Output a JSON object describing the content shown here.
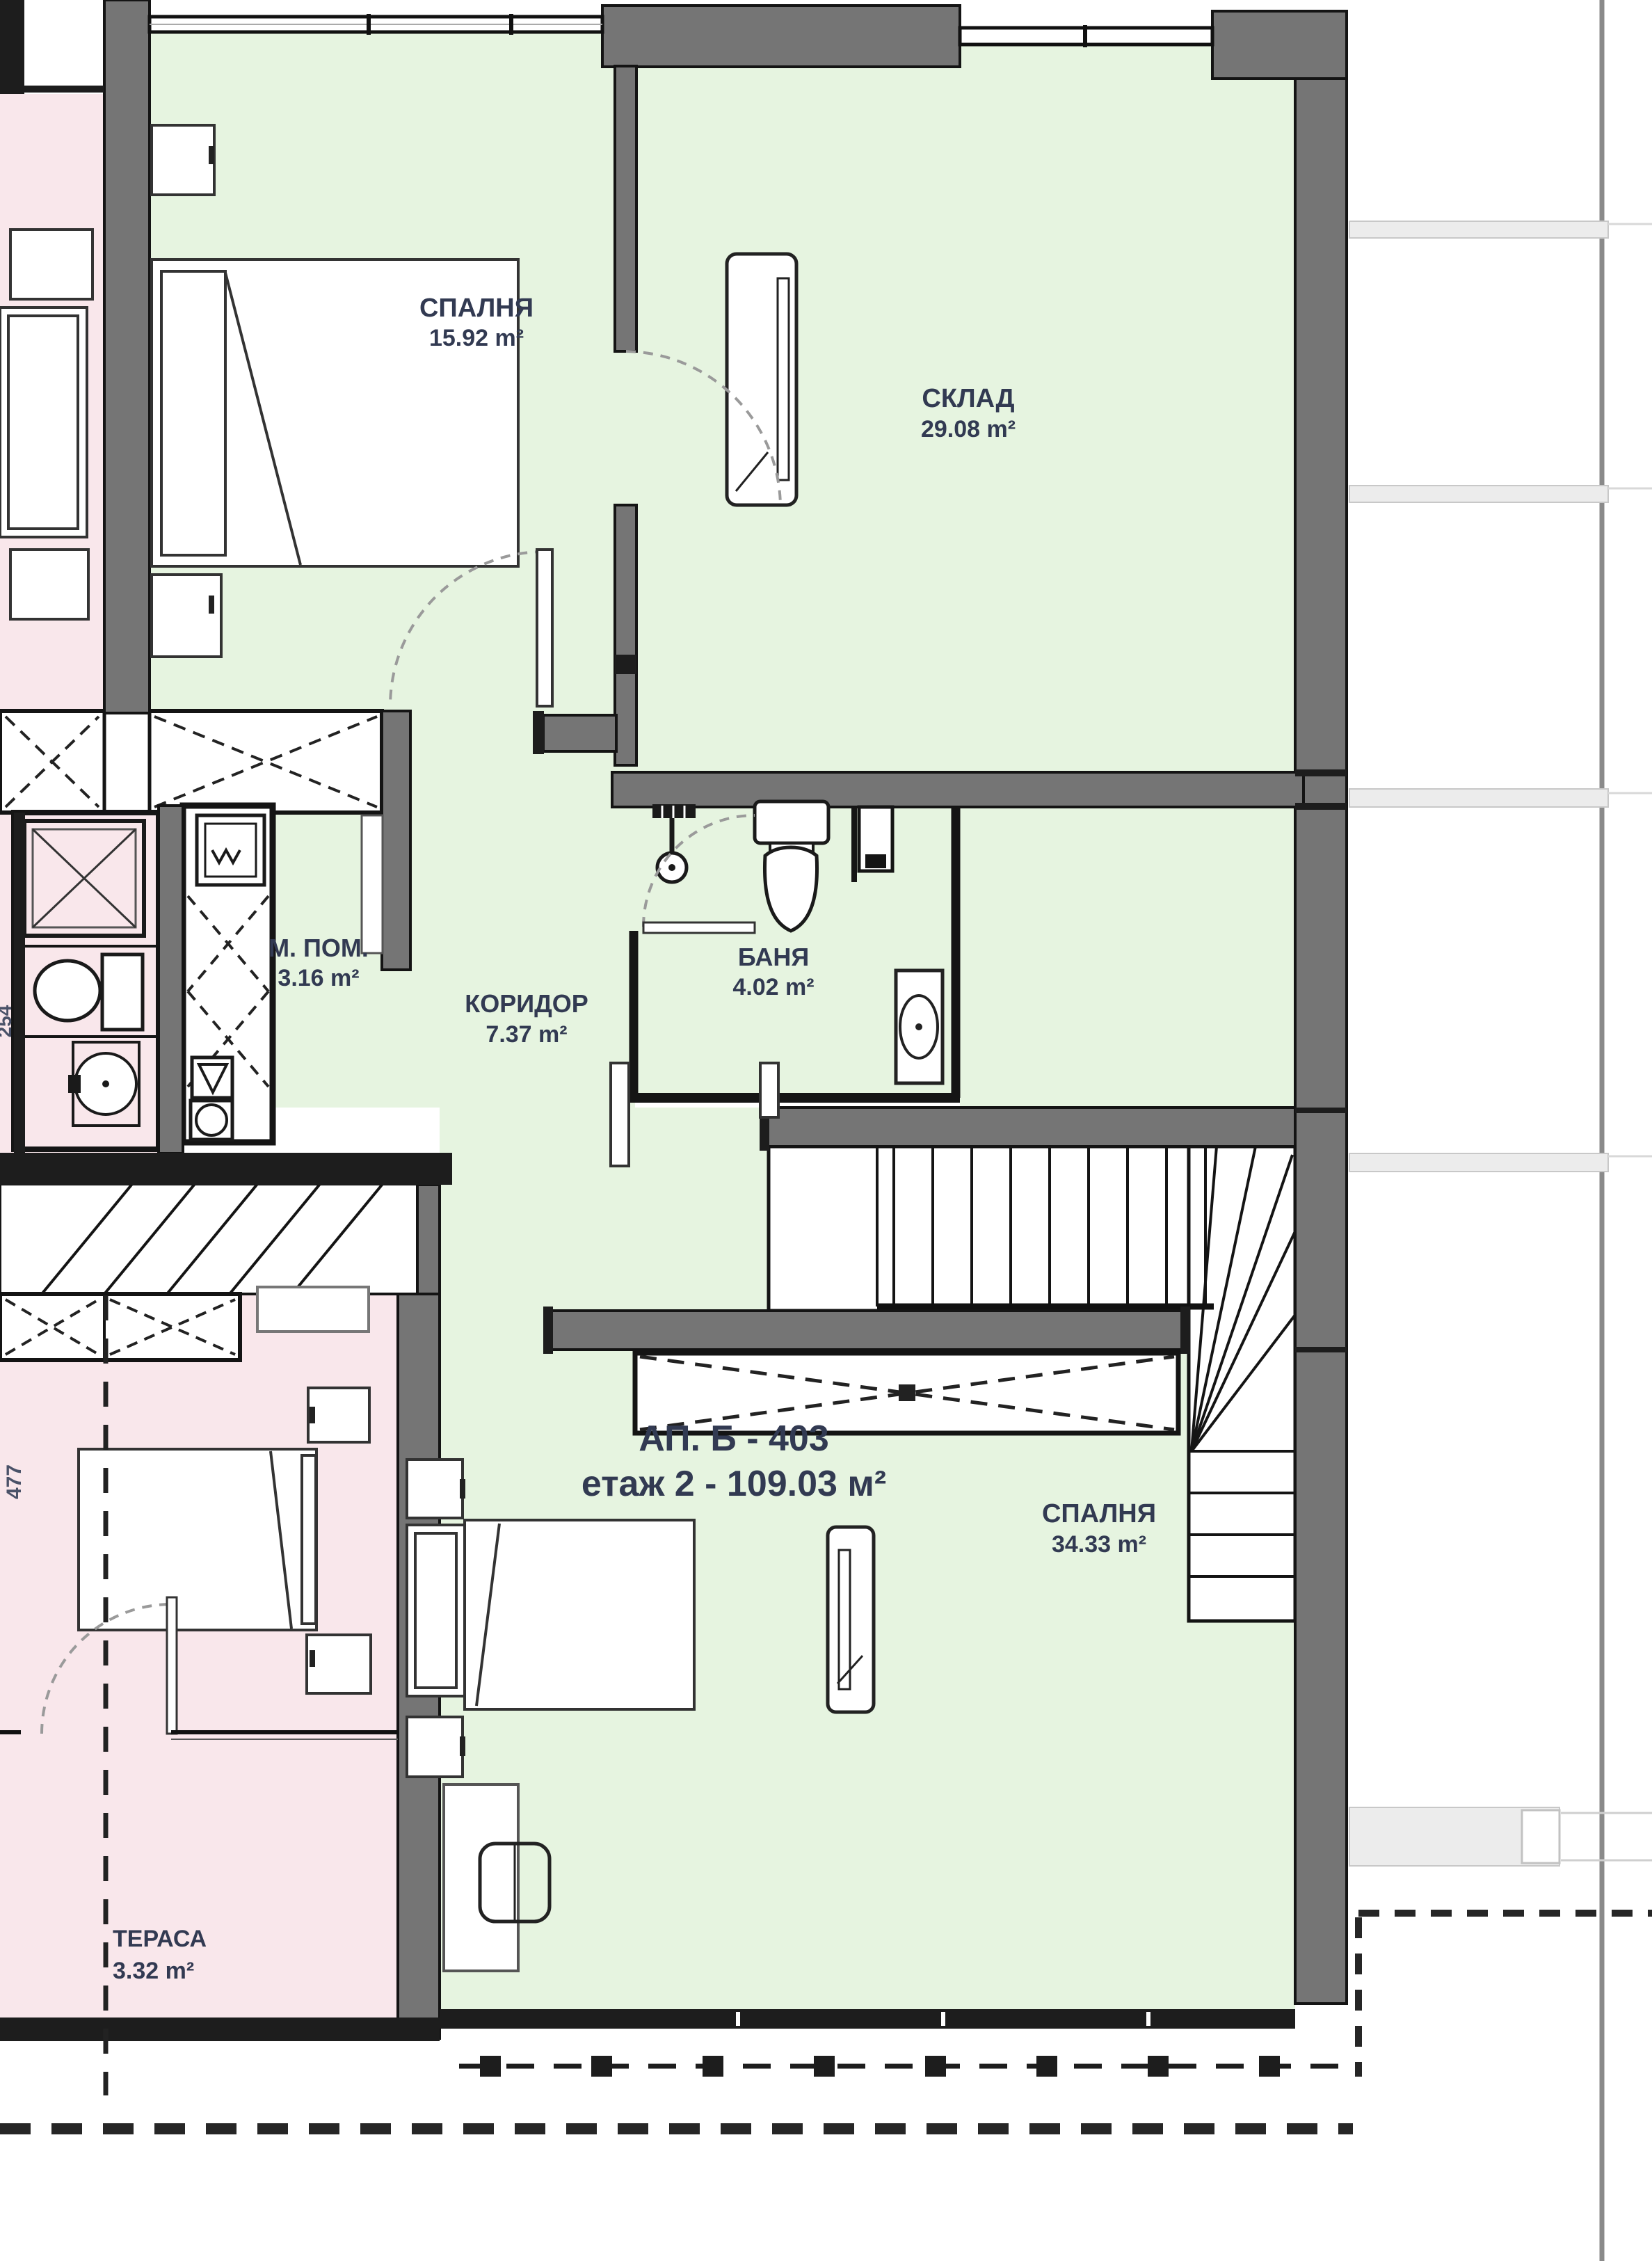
{
  "plan": {
    "apartment_label": {
      "line1": "АП. Б - 403",
      "line2": "етаж 2 - 109.03 м²"
    },
    "rooms": [
      {
        "name": "СПАЛНЯ",
        "area": "15.92 m²"
      },
      {
        "name": "СКЛАД",
        "area": "29.08 m²"
      },
      {
        "name": "М. ПОМ.",
        "area": "3.16 m²"
      },
      {
        "name": "КОРИДОР",
        "area": "7.37 m²"
      },
      {
        "name": "БАНЯ",
        "area": "4.02 m²"
      },
      {
        "name": "СПАЛНЯ",
        "area": "34.33 m²"
      },
      {
        "name": "ТЕРАСА",
        "area": "3.32 m²"
      }
    ],
    "dimensions": {
      "d1": "477",
      "d2": "254"
    },
    "colors": {
      "room_green": "#e6f4e0",
      "room_pink": "#f9e7eb",
      "wall_gray": "#757575",
      "wall_black": "#1d1d1d",
      "label_text": "#323a52",
      "exterior_slab": "#ececec"
    }
  }
}
